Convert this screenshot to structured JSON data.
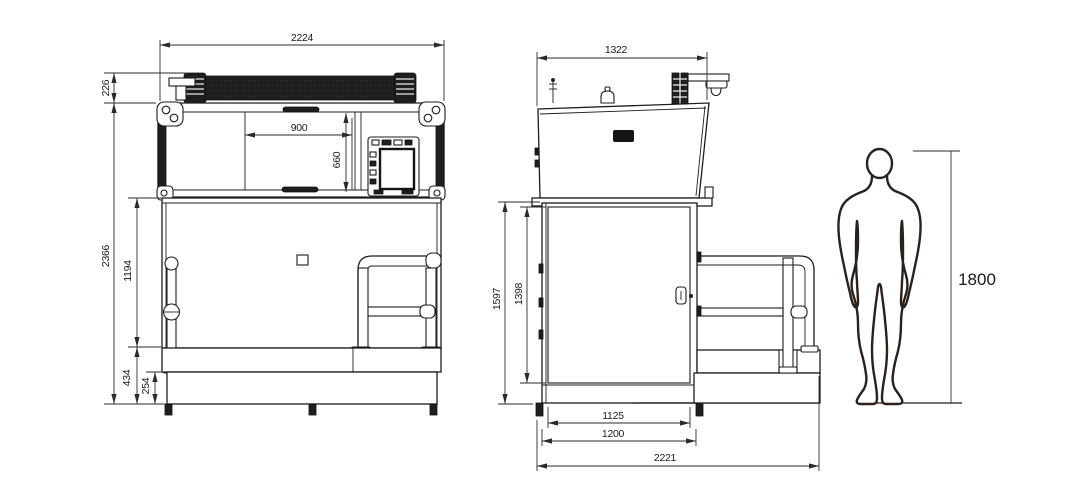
{
  "colors": {
    "line": "#1d1d1f",
    "dimension_line": "#2b2b2b",
    "dark_fill": "#1e1e1e",
    "background": "#ffffff"
  },
  "dimensions": {
    "front": {
      "overall_width": "2224",
      "top_roller_height": "226",
      "window_width": "900",
      "window_height": "660",
      "overall_height": "2366",
      "lower_body_height": "1194",
      "base_height": "434",
      "plinth_height": "254"
    },
    "side": {
      "top_width": "1322",
      "cabinet_height": "1597",
      "door_height": "1398",
      "base_inner_width": "1125",
      "base_width": "1200",
      "overall_depth": "2221"
    },
    "human": {
      "height": "1800"
    }
  }
}
